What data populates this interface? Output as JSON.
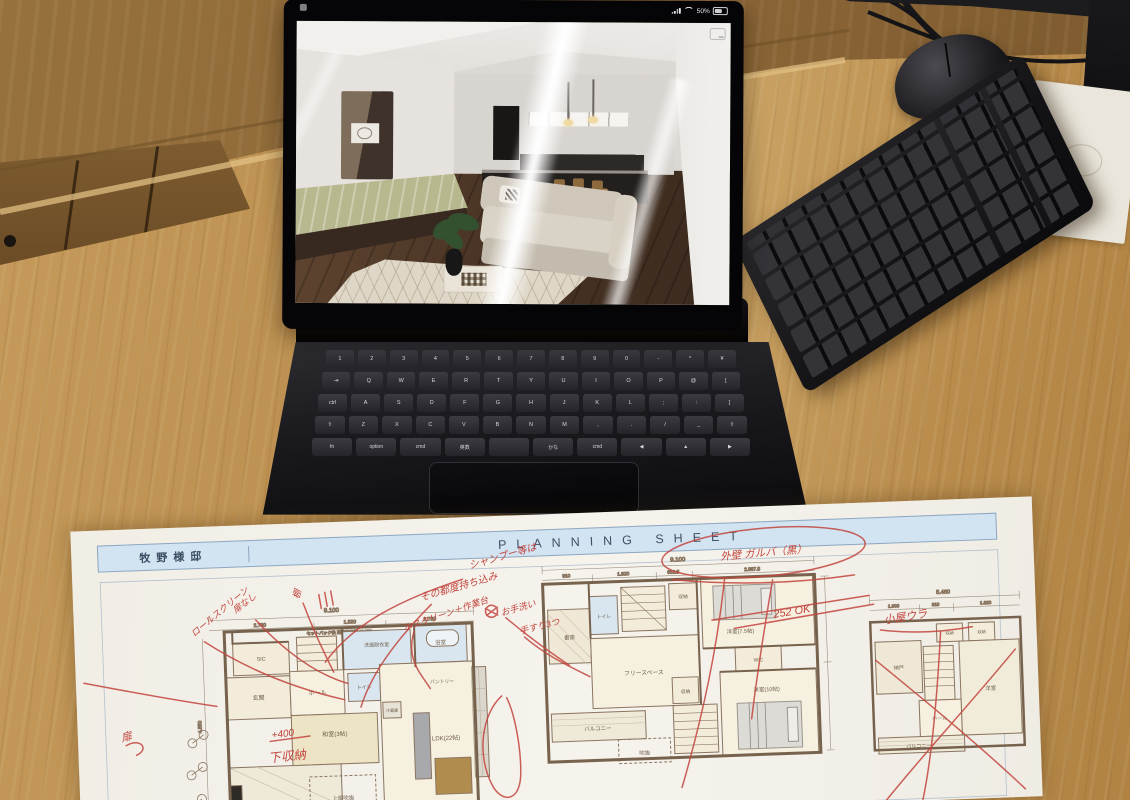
{
  "ipad": {
    "status": {
      "battery_percent": "50%"
    }
  },
  "magic_keyboard": {
    "row_numbers": [
      "1",
      "2",
      "3",
      "4",
      "5",
      "6",
      "7",
      "8",
      "9",
      "0",
      "-",
      "^",
      "¥"
    ],
    "row_top": [
      "⇥",
      "Q",
      "W",
      "E",
      "R",
      "T",
      "Y",
      "U",
      "I",
      "O",
      "P",
      "@",
      "["
    ],
    "row_home": [
      "ctrl",
      "A",
      "S",
      "D",
      "F",
      "G",
      "H",
      "J",
      "K",
      "L",
      ";",
      ":",
      "]"
    ],
    "row_bottom": [
      "⇧",
      "Z",
      "X",
      "C",
      "V",
      "B",
      "N",
      "M",
      ",",
      ".",
      "/",
      "_",
      "⇧"
    ],
    "bottom": {
      "fn": "fn",
      "option": "option",
      "cmd_left": "cmd",
      "eisu": "英数",
      "space": "",
      "kana": "かな",
      "cmd_right": "cmd",
      "arrow_left": "◀",
      "arrow_up_down": "▲",
      "arrow_right": "▶"
    }
  },
  "sheet": {
    "client": "牧野様邸",
    "title": "PLANNING SHEET",
    "plan_1f": {
      "rooms": [
        "SIC",
        "玄関",
        "ホール",
        "和室(3帖)",
        "洗面脱衣室",
        "浴室",
        "トイレ",
        "パントリー",
        "LDK(22帖)",
        "上部吹抜",
        "冷蔵庫"
      ],
      "dims": [
        "9.100",
        "2.730",
        "1.820",
        "2.730",
        "4.550"
      ],
      "setback": "セットバック後 道路境界線 10.950"
    },
    "plan_2f": {
      "rooms": [
        "書斎",
        "トイレ",
        "収納",
        "洋室(7.5帖)",
        "WIC",
        "フリースペース",
        "収納",
        "洋室(10帖)",
        "バルコニー",
        "吹抜"
      ],
      "dims": [
        "9.100",
        "910",
        "1.820",
        "682.5",
        "2.887.5"
      ]
    },
    "plan_attic": {
      "rooms": [
        "納戸",
        "収納",
        "収納",
        "洋室",
        "ホール",
        "バルコニー"
      ],
      "dims": [
        "5.460",
        "1.900",
        "910",
        "1.820"
      ]
    },
    "annotations": {
      "note_top_1": "シャンプー等は",
      "note_top_2": "その都度持ち込み",
      "wall_note": "外壁 ガルバ（黒）",
      "wall_ok": "252 OK",
      "roll_screen": "ロールスクリーン",
      "no_door": "扉なし",
      "shelf": "棚",
      "hoscreen": "ホスクリーン＋作業台",
      "handwash": "お手洗い",
      "rails": "手すり3つ",
      "plus400": "+400",
      "lower_storage": "下収納",
      "door": "扉",
      "attic": "小屋ウラ"
    }
  }
}
